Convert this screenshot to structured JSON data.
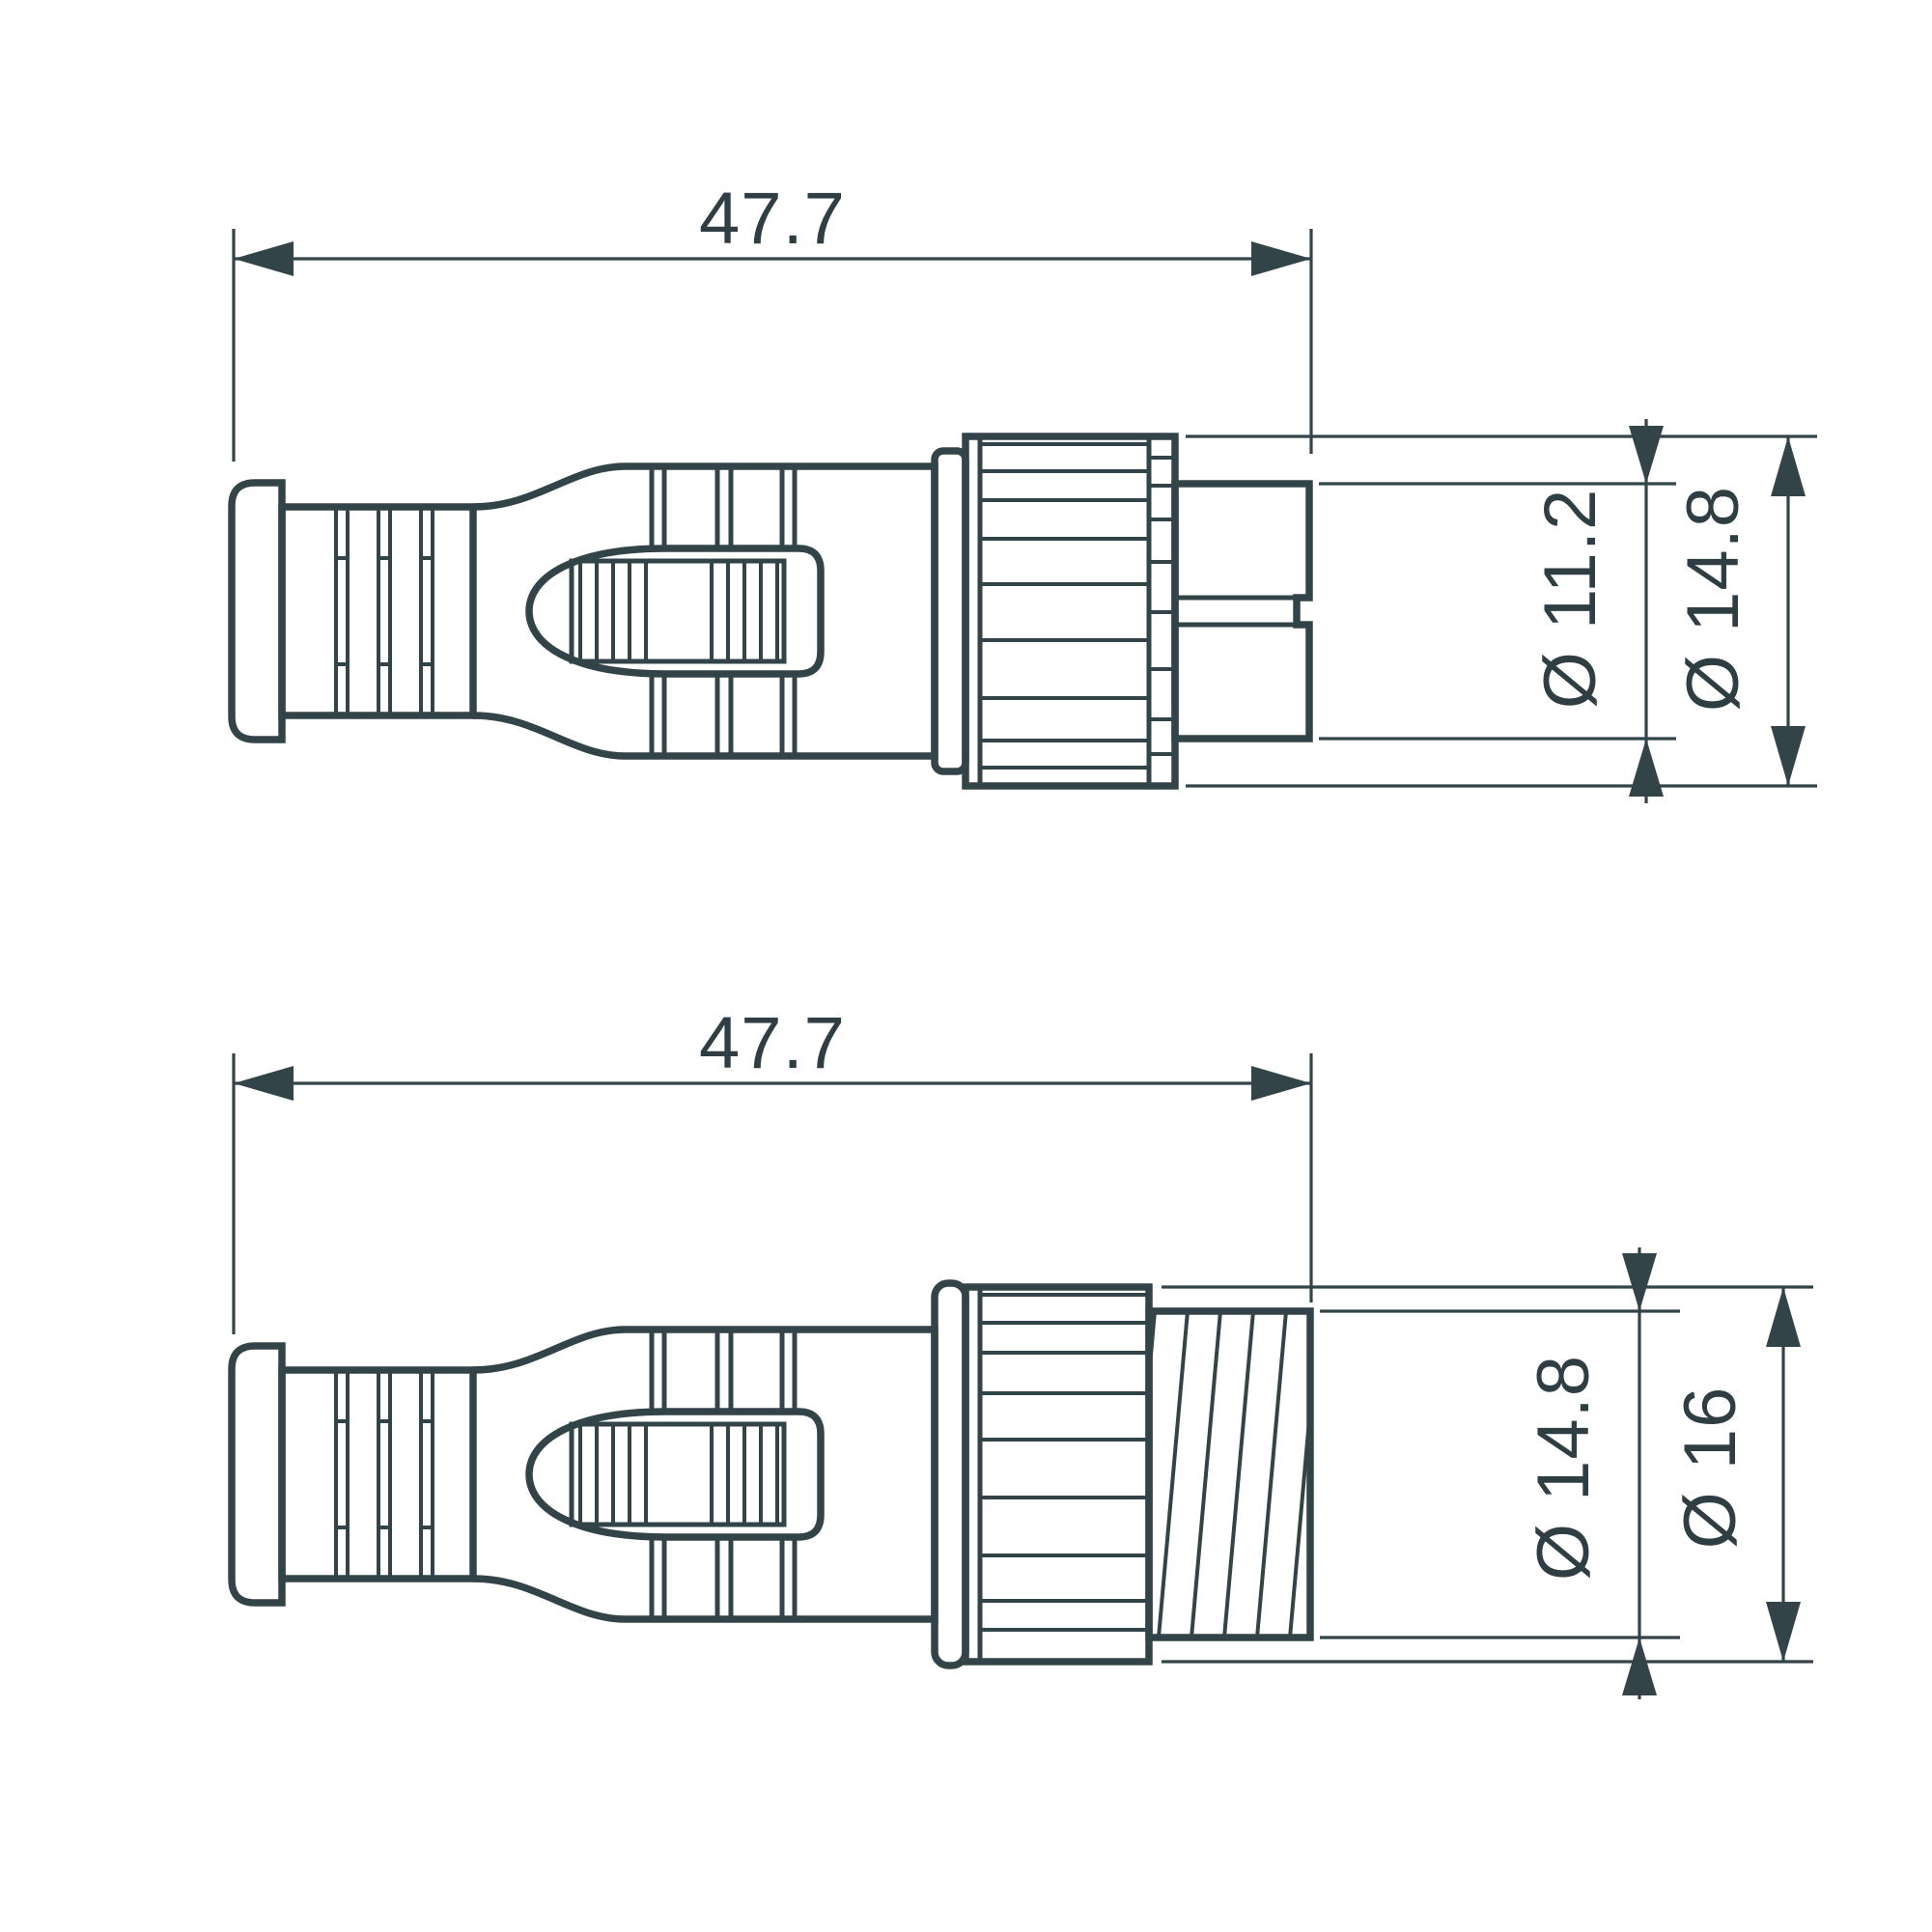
{
  "page": {
    "title": "Connector dimensional drawing",
    "background_color": "#ffffff"
  },
  "drawing": {
    "stroke_color": "#334449",
    "text_color": "#2f3e43",
    "views": {
      "top": {
        "name": "male connector side view",
        "length_label": "47.7",
        "inner_diameter_label": "Ø 11.2",
        "outer_diameter_label": "Ø 14.8"
      },
      "bottom": {
        "name": "female connector side view",
        "length_label": "47.7",
        "inner_diameter_label": "Ø 14.8",
        "outer_diameter_label": "Ø 16"
      }
    }
  },
  "dims": {
    "top_length": "47.7",
    "top_small": "Ø 11.2",
    "top_large": "Ø 14.8",
    "bottom_length": "47.7",
    "bottom_small": "Ø 14.8",
    "bottom_large": "Ø 16"
  }
}
